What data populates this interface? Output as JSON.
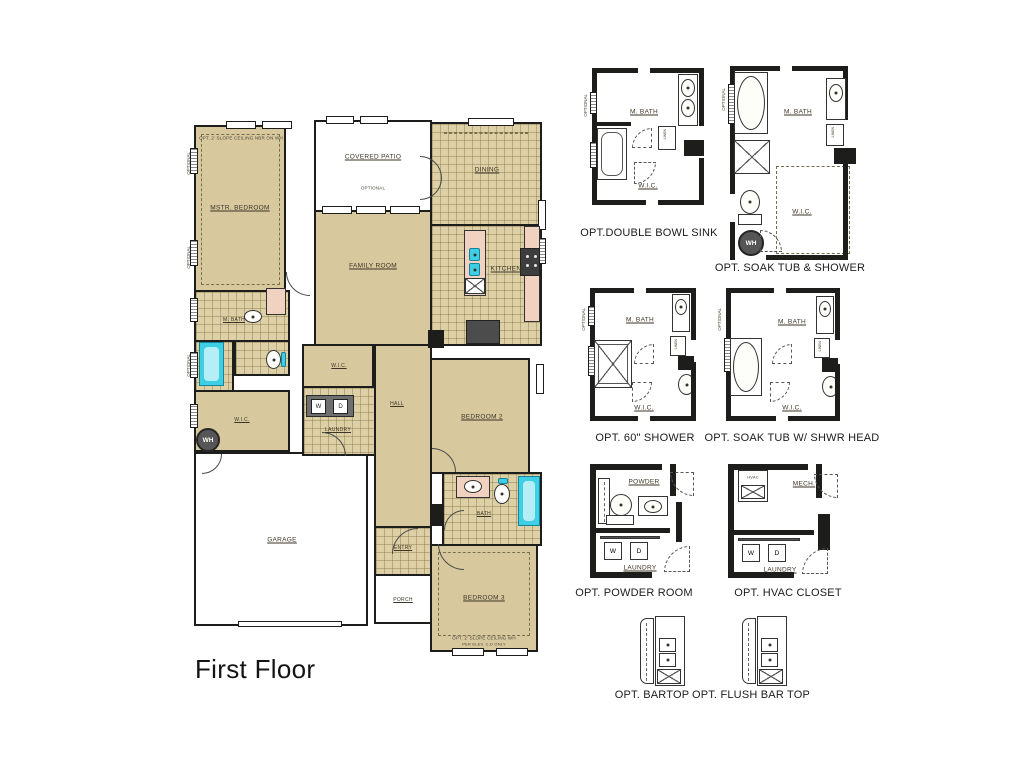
{
  "title": "First Floor",
  "colors": {
    "wall": "#1d1d1b",
    "room_beige": "#d7c89e",
    "tile_beige": "#ddd0a6",
    "fixture_pink": "#f1d2c1",
    "fixture_cyan": "#3ecfe5",
    "label": "#3c3526"
  },
  "main_plan": {
    "rooms": {
      "mstr_bedroom": "MSTR. BEDROOM",
      "covered_patio": "COVERED PATIO",
      "family_room": "FAMILY ROOM",
      "dining": "DINING",
      "kitchen": "KITCHEN",
      "m_bath": "M. BATH",
      "wic_master": "W.I.C.",
      "wic_hall": "W.I.C.",
      "laundry": "LAUNDRY",
      "hall": "HALL",
      "bedroom2": "BEDROOM 2",
      "bath2": "BATH",
      "bedroom3": "BEDROOM 3",
      "entry": "ENTRY",
      "porch": "PORCH",
      "garage": "GARAGE"
    },
    "appliances": {
      "washer": "W",
      "dryer": "D",
      "water_heater": "WH"
    },
    "annotations": {
      "mstr_ceiling_note": "OPT. 2' SLOPE CEILING  NBR ON WH",
      "bedroom3_ceiling_note": "OPT. 2' SLOPE CEILING  WH",
      "bedroom3_elev_note": "PER ELEV. C,D ONLY",
      "optional": "OPTIONAL"
    }
  },
  "options": {
    "double_bowl_sink": {
      "caption": "OPT.DOUBLE BOWL SINK",
      "m_bath": "M. BATH",
      "wic": "W.I.C.",
      "linen": "LINEN"
    },
    "soak_tub_shower": {
      "caption": "OPT. SOAK TUB & SHOWER",
      "m_bath": "M. BATH",
      "wic": "W.I.C.",
      "linen": "LINEN",
      "wh": "WH"
    },
    "shower_60": {
      "caption": "OPT. 60\" SHOWER",
      "m_bath": "M. BATH",
      "wic": "W.I.C.",
      "linen": "LINEN"
    },
    "soak_tub_shwr_head": {
      "caption": "OPT. SOAK TUB W/ SHWR HEAD",
      "m_bath": "M. BATH",
      "wic": "W.I.C.",
      "linen": "LINEN"
    },
    "powder_room": {
      "caption": "OPT. POWDER ROOM",
      "powder": "POWDER",
      "laundry": "LAUNDRY",
      "washer": "W",
      "dryer": "D"
    },
    "hvac_closet": {
      "caption": "OPT. HVAC CLOSET",
      "mech": "MECH.",
      "laundry": "LAUNDRY",
      "washer": "W",
      "dryer": "D",
      "hvac": "HVAC"
    },
    "bartop": {
      "caption": "OPT. BARTOP"
    },
    "flush_bartop": {
      "caption": "OPT. FLUSH BAR TOP"
    }
  }
}
